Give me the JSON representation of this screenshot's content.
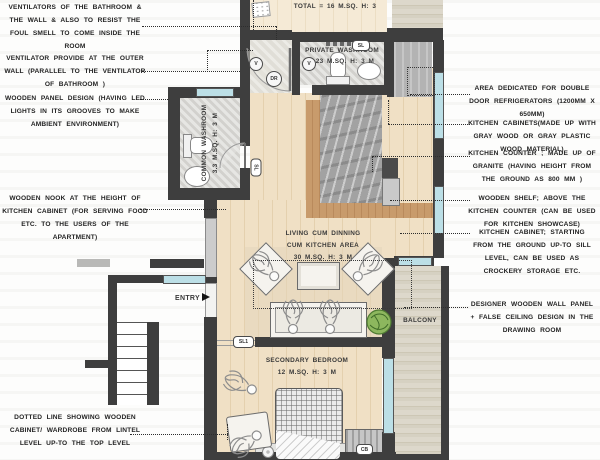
{
  "annotations": {
    "left": [
      "VENTILATORS OF THE BATHROOM & THE WALL & ALSO TO RESIST THE FOUL SMELL TO COME INSIDE THE ROOM",
      "VENTILATOR PROVIDE AT THE OUTER WALL (PARALLEL TO THE VENTILATOR OF BATHROOM )",
      "WOODEN PANEL DESIGN (HAVING LED LIGHTS IN ITS GROOVES TO MAKE AMBIENT ENVIRONMENT)",
      "WOODEN NOOK AT THE HEIGHT OF KITCHEN CABINET (FOR SERVING FOOD ETC. TO THE USERS OF THE APARTMENT)",
      "DOTTED LINE SHOWING WOODEN CABINET/ WARDROBE FROM LINTEL LEVEL UP-TO THE TOP LEVEL"
    ],
    "right": [
      "AREA DEDICATED FOR DOUBLE DOOR REFRIGERATORS (1200MM X 650MM)",
      "KITCHEN CABINETS(MADE UP WITH GRAY WOOD OR GRAY PLASTIC WOOD MATERIAL)",
      "KITCHEN COUNTER ; MADE UP OF GRANITE (HAVING HEIGHT FROM THE GROUND AS 800 MM )",
      "WOODEN SHELF; ABOVE THE KITCHEN COUNTER (CAN BE USED FOR KITCHEN SHOWCASE)",
      "KITCHEN CABINET; STARTING FROM THE GROUND UP-TO SILL LEVEL, CAN BE USED AS CROCKERY STORAGE ETC.",
      "DESIGNER WOODEN WALL PANEL + FALSE CEILING DESIGN IN THE DRAWING ROOM"
    ]
  },
  "rooms": {
    "top_room_total": "TOTAL = 16 M.SQ. H: 3",
    "private_washroom_name": "PRIVATE WASHROOM",
    "private_washroom_size": "2.23 M.SQ. H: 3 M",
    "common_washroom_name": "COMMON WASHROOM",
    "common_washroom_size": "3.3 M.SQ. H: 3 M",
    "living_line1": "LIVING CUM DINNING",
    "living_line2": "CUM KITCHEN AREA",
    "living_line3": "30 M.SQ. H: 3 M",
    "bedroom_name": "SECONDARY BEDROOM",
    "bedroom_size": "12 M.SQ. H: 3 M",
    "balcony": "BALCONY",
    "entry": "ENTRY"
  },
  "badges": {
    "v": "V",
    "dr": "DR",
    "sl": "SL",
    "sl1": "SL1",
    "cb": "CB"
  },
  "colors": {
    "wall": "#3e3e3e",
    "wood_floor": "#efdfc5",
    "granite": "#a2a2a2",
    "counter_wood": "#c89b6c",
    "window": "#bcdfe6",
    "tile": "#d9d8d4",
    "plant": "#79a84e",
    "text": "#232323"
  }
}
